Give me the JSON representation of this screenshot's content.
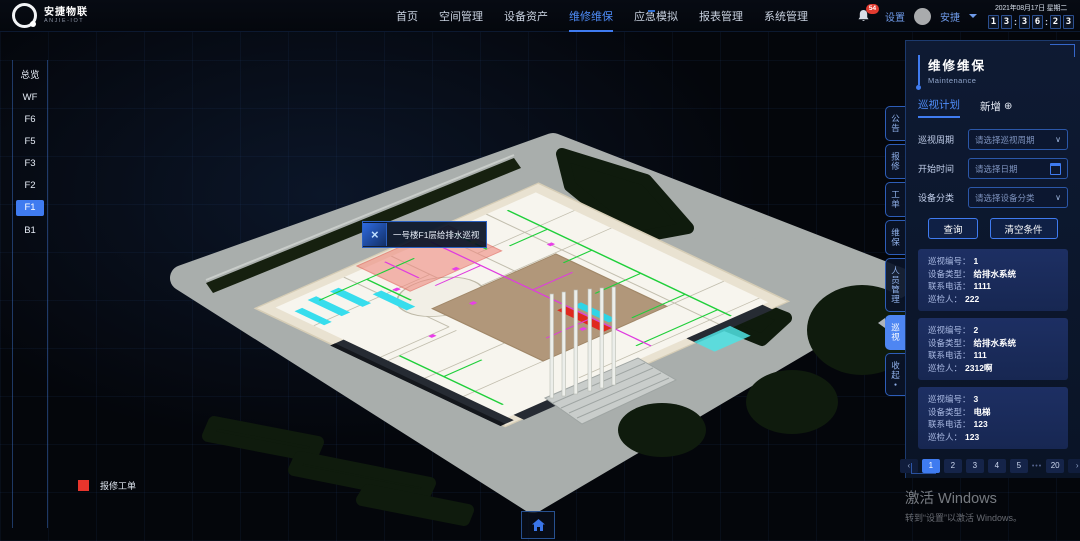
{
  "header": {
    "logo": {
      "title": "安捷物联",
      "subtitle": "ANJIE-IOT"
    },
    "nav": [
      {
        "label": "首页"
      },
      {
        "label": "空间管理"
      },
      {
        "label": "设备资产"
      },
      {
        "label": "维修维保"
      },
      {
        "label": "应急模拟"
      },
      {
        "label": "报表管理"
      },
      {
        "label": "系统管理"
      }
    ],
    "active_nav": "维修维保",
    "notifications": {
      "count": "54"
    },
    "settings_label": "设置",
    "user": {
      "name": "安捷"
    },
    "datetime": {
      "date": "2021年08月17日 星期二",
      "digits": [
        "1",
        "3",
        "3",
        "6",
        "2",
        "3"
      ],
      "separator": ":"
    }
  },
  "floors": {
    "active": "F1",
    "items": [
      {
        "label": "总览"
      },
      {
        "label": "WF"
      },
      {
        "label": "F6"
      },
      {
        "label": "F5"
      },
      {
        "label": "F3"
      },
      {
        "label": "F2"
      },
      {
        "label": "F1"
      },
      {
        "label": "B1"
      }
    ]
  },
  "scene": {
    "tooltip_label": "一号楼F1层给排水巡视",
    "legend": {
      "label": "报修工单",
      "color": "#e8352c"
    }
  },
  "side_tabs": {
    "active": "巡视",
    "items": [
      {
        "label": "公告"
      },
      {
        "label": "报修"
      },
      {
        "label": "工单"
      },
      {
        "label": "维保"
      },
      {
        "label": "人员管理"
      },
      {
        "label": "巡视"
      },
      {
        "label": "收起"
      }
    ]
  },
  "panel": {
    "title": "维修维保",
    "subtitle": "Maintenance",
    "tabs": {
      "plan": "巡视计划",
      "add": "新增"
    },
    "form": {
      "cycle": {
        "label": "巡视周期",
        "placeholder": "请选择巡视周期"
      },
      "start": {
        "label": "开始时间",
        "placeholder": "请选择日期"
      },
      "category": {
        "label": "设备分类",
        "placeholder": "请选择设备分类"
      }
    },
    "actions": {
      "query": "查询",
      "clear": "清空条件"
    },
    "cards": [
      {
        "rows": [
          {
            "label": "巡视编号：",
            "value": "1"
          },
          {
            "label": "设备类型：",
            "value": "给排水系统"
          },
          {
            "label": "联系电话：",
            "value": "1111"
          },
          {
            "label": "巡检人：",
            "value": "222"
          }
        ]
      },
      {
        "rows": [
          {
            "label": "巡视编号：",
            "value": "2"
          },
          {
            "label": "设备类型：",
            "value": "给排水系统"
          },
          {
            "label": "联系电话：",
            "value": "111"
          },
          {
            "label": "巡检人：",
            "value": "2312啊"
          }
        ]
      },
      {
        "rows": [
          {
            "label": "巡视编号：",
            "value": "3"
          },
          {
            "label": "设备类型：",
            "value": "电梯"
          },
          {
            "label": "联系电话：",
            "value": "123"
          },
          {
            "label": "巡检人：",
            "value": "123"
          }
        ]
      }
    ],
    "pagination": {
      "prev": "‹",
      "next": "›",
      "pages": [
        "1",
        "2",
        "3",
        "4",
        "5"
      ],
      "ellipsis": "•••",
      "last": "20",
      "active": "1"
    }
  },
  "icons": {
    "plus": "⊕",
    "chevron_down": "∨",
    "marker": "×",
    "dot": "●"
  },
  "accent_color": "#3f7bf0",
  "watermark": {
    "line1": "激活 Windows",
    "line2": "转到“设置”以激活 Windows。"
  }
}
